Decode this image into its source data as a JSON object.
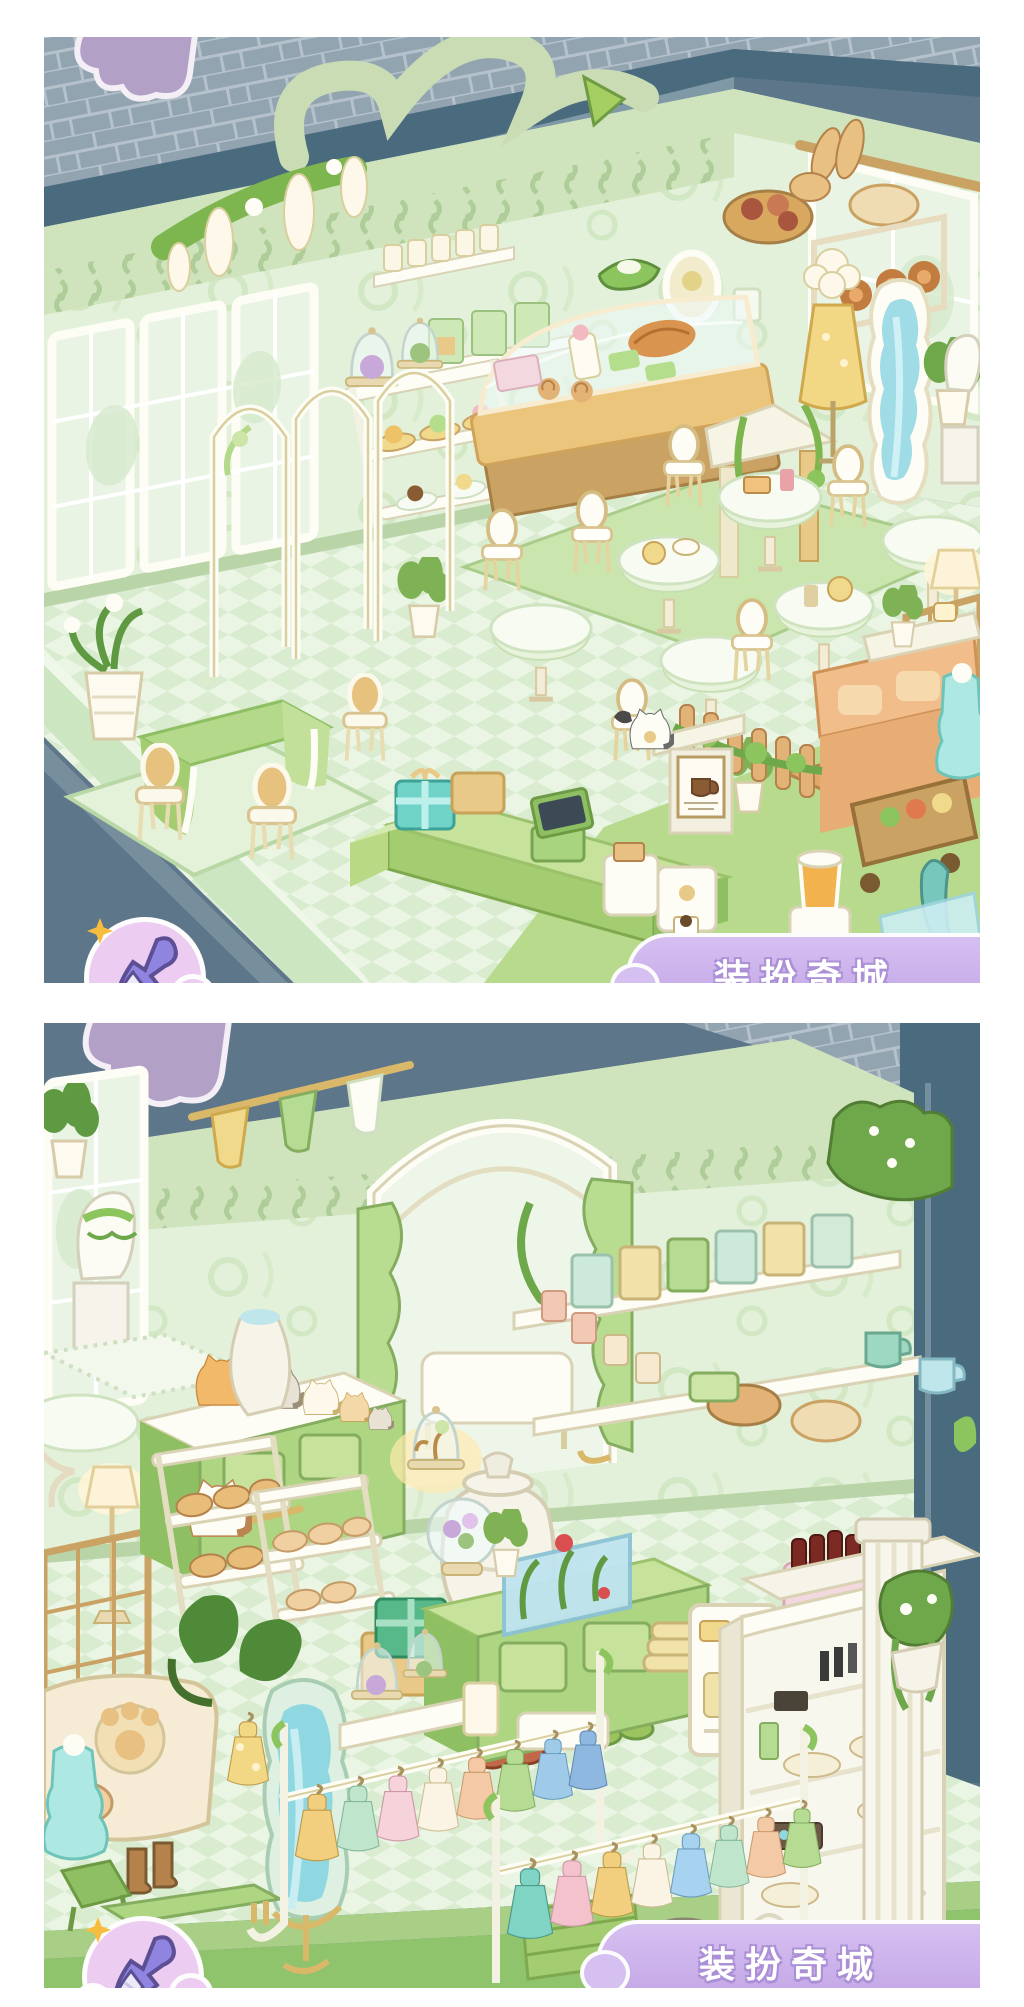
{
  "app": {
    "description": "Two stacked screenshots of a pastel-green isometric room-decoration game (cafe and boutique scenes) on a white background",
    "layout": {
      "border_color": "#ffffff",
      "street_color": "#5e7689"
    }
  },
  "ui": {
    "decorate_button": {
      "icon": "paintbrush-icon",
      "badge": "sparkle-icon",
      "bubble_color": "#ecccf0",
      "brush_color": "#8f84e0"
    },
    "event_banner": {
      "label": "装扮奇城",
      "bg_color": "#c9aee6",
      "text_color": "#ffffff",
      "outline_color": "#ab90d6",
      "note": "text partially cut off by screenshot edge"
    }
  },
  "palette": {
    "wall_green": "#e3f1da",
    "cornice": "#cfe4bd",
    "floor_light": "#eaf5e4",
    "floor_dark": "#d9ecd0",
    "street": "#5e7689",
    "road": "#4a6b7e",
    "pavement": "#93a4b1",
    "grass": "#93c671",
    "gold": "#e0b76a",
    "cream": "#fbf8ec",
    "mint_furniture": "#aed581",
    "teal_gift": "#6fd3c8",
    "aqua_mirror": "#8fd8e2",
    "orange_sofa": "#f0bd8b",
    "cloud_purple": "#b3a0c6"
  },
  "scene_top": {
    "name": "pastel cafe interior",
    "items": [
      "script-sign",
      "wisteria-garland",
      "tall-windows",
      "arched-partition",
      "wall-shelf-jars",
      "tea-bag-shelf",
      "green-hat",
      "oval-mirror",
      "dessert-cart-with-cloches",
      "golden-bakery-display-case",
      "bread-baskets",
      "door-pediment-stand",
      "mannequin-yellow-dress",
      "wavy-standing-mirror",
      "potted-palm",
      "bust-statue",
      "cafe-tables-with-desserts",
      "white-gold-chairs",
      "green-rug",
      "floor-lamp",
      "flower-trellis",
      "hamster-at-tea-table",
      "orange-sofa-set",
      "ivy-picket-fence",
      "grocery-cart",
      "teal-umbrella",
      "juice-blender",
      "blue-tiered-dress",
      "dining-table-green-cloth",
      "cream-chairs",
      "potted-lily",
      "cashier-counter",
      "teal-gift-box",
      "cash-register",
      "toaster",
      "coffee-machine",
      "coffee-poster-stand",
      "tuxedo-cat",
      "purple-cloud"
    ]
  },
  "scene_bottom": {
    "name": "pastel boutique / goods shop interior",
    "items": [
      "bust-statue",
      "pennant-flags",
      "hanging-flower-baskets",
      "green-sideboard",
      "row-of-cats",
      "glowing-cloche",
      "white-urn",
      "white-jug",
      "calico-cat",
      "canopy-alcove-green-curtains",
      "round-side-table",
      "floor-lamp",
      "lattice-screen",
      "bakery-racks-with-bread",
      "cat-paw-sofa",
      "monstera-plant",
      "wavy-mint-mirror",
      "gift-boxes",
      "shoes-row",
      "white-boots",
      "siamese-cat",
      "gray-cat",
      "center-counter",
      "aquarium",
      "snow-globe",
      "folded-towels",
      "glass-cloches-table",
      "wall-shelf-tea-boxes-and-mugs",
      "drink-dispenser",
      "cola-crate",
      "cosmetics-display-cabinet",
      "white-column",
      "ivy-planter",
      "hedge",
      "clothing-racks-with-dresses",
      "mint-tiered-dress",
      "yellow-lace-dress",
      "brown-boots",
      "step-stool",
      "wooden-bench",
      "stone-path",
      "steps",
      "purple-cloud"
    ]
  },
  "dress_rack_colors": {
    "rack1": [
      "#f2cf7e",
      "#bfe6cc",
      "#f6d2da",
      "#fbf4e4",
      "#f4c9a6",
      "#b5dc92",
      "#9fcbe8",
      "#8fb8e0"
    ],
    "rack2": [
      "#7fd4c4",
      "#f4c2cc",
      "#f2cf7e",
      "#fbf4e4",
      "#a8d3f0",
      "#bfe6cc",
      "#f4c9a6",
      "#b5dc92"
    ]
  }
}
